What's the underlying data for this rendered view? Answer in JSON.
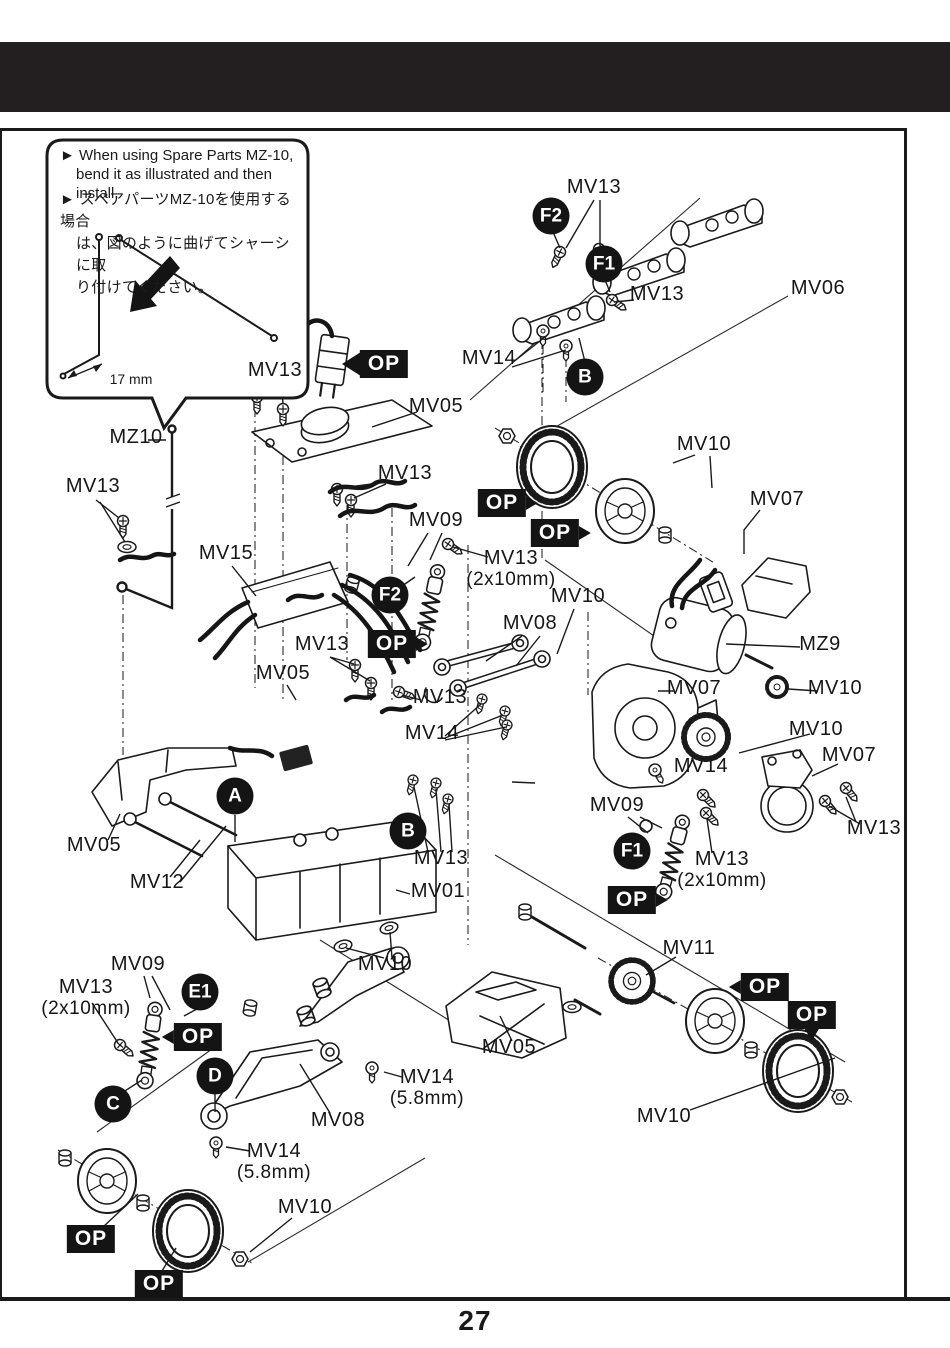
{
  "page": {
    "number": "27"
  },
  "colors": {
    "ink": "#1a1a1a",
    "header_bar": "#231f20",
    "badge_bg": "#141414"
  },
  "note_box": {
    "en_line1": "► When using Spare Parts MZ-10,",
    "en_line2": "bend it as illustrated and then install.",
    "jp_line1": "► スペアパーツMZ-10を使用する場合",
    "jp_line2": "は、図のように曲げてシャーシに取",
    "jp_line3": "り付けてください。",
    "dimension": "17 mm"
  },
  "diagram": {
    "part_labels": [
      {
        "text": "MV13",
        "x": 594,
        "y": 190
      },
      {
        "text": "MV06",
        "x": 818,
        "y": 291
      },
      {
        "text": "MV13",
        "x": 657,
        "y": 297
      },
      {
        "text": "MV14",
        "x": 489,
        "y": 361
      },
      {
        "text": "MV13",
        "x": 275,
        "y": 373
      },
      {
        "text": "MV05",
        "x": 436,
        "y": 409
      },
      {
        "text": "MV13",
        "x": 405,
        "y": 476
      },
      {
        "text": "MV09",
        "x": 436,
        "y": 523
      },
      {
        "text": "MV13",
        "sub": "(2x10mm)",
        "x": 511,
        "y": 561
      },
      {
        "text": "MV10",
        "x": 704,
        "y": 447
      },
      {
        "text": "MV07",
        "x": 777,
        "y": 502
      },
      {
        "text": "MV10",
        "x": 578,
        "y": 599
      },
      {
        "text": "MV08",
        "x": 530,
        "y": 626
      },
      {
        "text": "MZ9",
        "x": 820,
        "y": 647
      },
      {
        "text": "MV07",
        "x": 694,
        "y": 691
      },
      {
        "text": "MV10",
        "x": 835,
        "y": 691
      },
      {
        "text": "MV13",
        "x": 322,
        "y": 647
      },
      {
        "text": "MV05",
        "x": 283,
        "y": 676
      },
      {
        "text": "MV13",
        "x": 440,
        "y": 700
      },
      {
        "text": "MV14",
        "x": 432,
        "y": 736
      },
      {
        "text": "MV10",
        "x": 816,
        "y": 732
      },
      {
        "text": "MV14",
        "x": 701,
        "y": 769
      },
      {
        "text": "MV07",
        "x": 849,
        "y": 758
      },
      {
        "text": "MV13",
        "x": 874,
        "y": 831
      },
      {
        "text": "MV09",
        "x": 617,
        "y": 808
      },
      {
        "text": "MV13",
        "sub": "(2x10mm)",
        "x": 722,
        "y": 862
      },
      {
        "text": "MV01",
        "x": 438,
        "y": 894
      },
      {
        "text": "MV05",
        "x": 94,
        "y": 848
      },
      {
        "text": "MV12",
        "x": 157,
        "y": 885
      },
      {
        "text": "MV13",
        "x": 441,
        "y": 861
      },
      {
        "text": "MV10",
        "x": 385,
        "y": 967
      },
      {
        "text": "MV11",
        "x": 689,
        "y": 951
      },
      {
        "text": "MV05",
        "x": 509,
        "y": 1050
      },
      {
        "text": "MV09",
        "x": 138,
        "y": 967
      },
      {
        "text": "MV13",
        "sub": "(2x10mm)",
        "x": 86,
        "y": 990
      },
      {
        "text": "MV14",
        "sub": "(5.8mm)",
        "x": 427,
        "y": 1080
      },
      {
        "text": "MV08",
        "x": 338,
        "y": 1123
      },
      {
        "text": "MV14",
        "sub": "(5.8mm)",
        "x": 274,
        "y": 1154
      },
      {
        "text": "MV10",
        "x": 305,
        "y": 1210
      },
      {
        "text": "MV10",
        "x": 664,
        "y": 1119
      },
      {
        "text": "MZ10",
        "x": 136,
        "y": 440
      },
      {
        "text": "MV13",
        "x": 93,
        "y": 489
      },
      {
        "text": "MV15",
        "x": 226,
        "y": 556
      }
    ],
    "step_badges": [
      {
        "text": "F2",
        "x": 551,
        "y": 216
      },
      {
        "text": "F1",
        "x": 604,
        "y": 264
      },
      {
        "text": "B",
        "x": 585,
        "y": 377
      },
      {
        "text": "F2",
        "x": 390,
        "y": 595
      },
      {
        "text": "A",
        "x": 235,
        "y": 796
      },
      {
        "text": "B",
        "x": 408,
        "y": 831
      },
      {
        "text": "F1",
        "x": 632,
        "y": 851
      },
      {
        "text": "E1",
        "x": 200,
        "y": 992
      },
      {
        "text": "C",
        "x": 113,
        "y": 1104
      },
      {
        "text": "D",
        "x": 215,
        "y": 1076
      }
    ],
    "op_badges": [
      {
        "text": "OP",
        "x": 384,
        "y": 364,
        "ptr": "none"
      },
      {
        "text": "OP",
        "x": 502,
        "y": 503,
        "ptr": "right"
      },
      {
        "text": "OP",
        "x": 555,
        "y": 533,
        "ptr": "right"
      },
      {
        "text": "OP",
        "x": 392,
        "y": 644,
        "ptr": "right"
      },
      {
        "text": "OP",
        "x": 632,
        "y": 900,
        "ptr": "right"
      },
      {
        "text": "OP",
        "x": 765,
        "y": 987,
        "ptr": "left"
      },
      {
        "text": "OP",
        "x": 812,
        "y": 1015,
        "ptr": "down"
      },
      {
        "text": "OP",
        "x": 198,
        "y": 1037,
        "ptr": "left"
      },
      {
        "text": "OP",
        "x": 91,
        "y": 1239,
        "ptr": "none"
      },
      {
        "text": "OP",
        "x": 159,
        "y": 1284,
        "ptr": "none"
      }
    ]
  }
}
